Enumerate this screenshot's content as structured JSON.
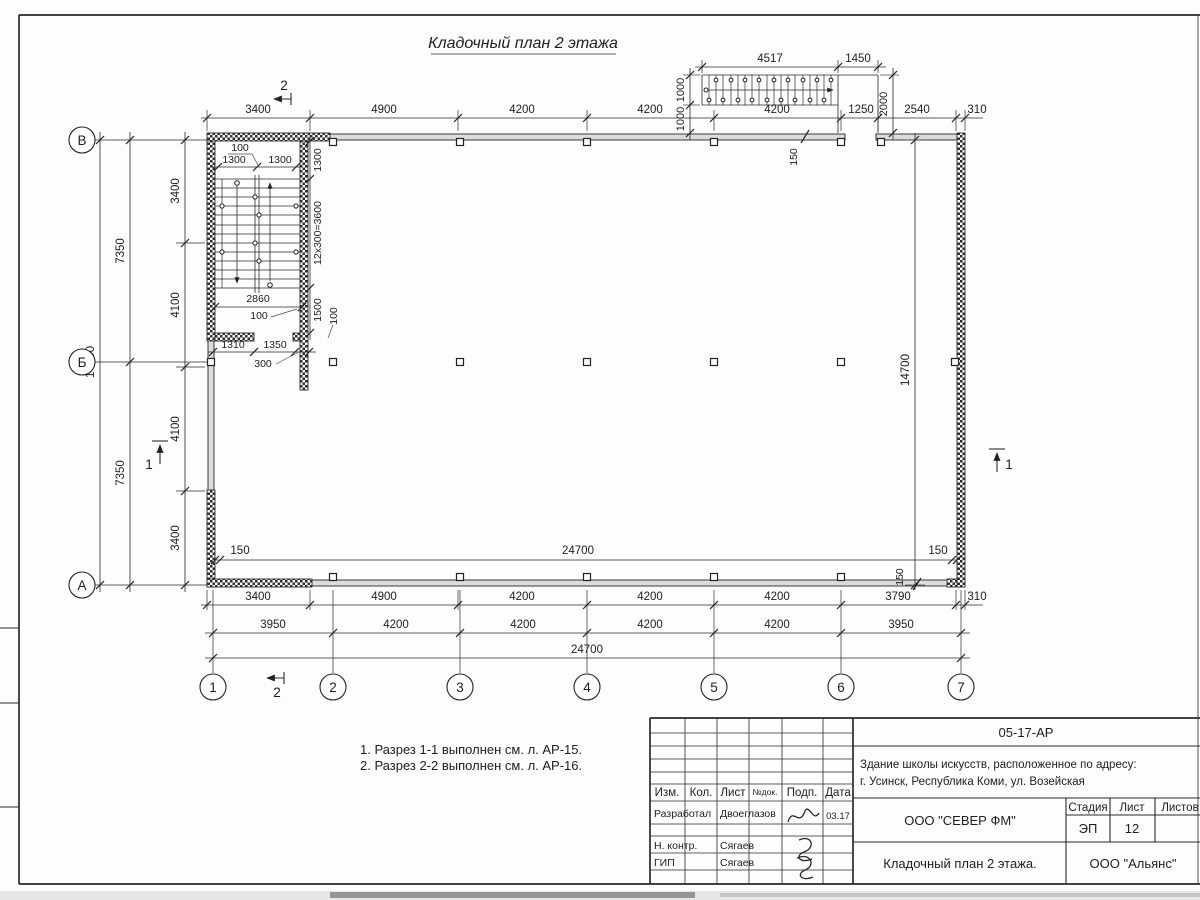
{
  "sheet": {
    "title": "Кладочный план 2 этажа"
  },
  "notes": {
    "line1": "1. Разрез 1-1 выполнен см. л. АР-15.",
    "line2": "2. Разрез 2-2 выполнен см. л. АР-16."
  },
  "axes": {
    "rows": [
      "В",
      "Б",
      "А"
    ],
    "cols": [
      "1",
      "2",
      "3",
      "4",
      "5",
      "6",
      "7"
    ]
  },
  "sections": {
    "s1": "1",
    "s2": "2"
  },
  "dims": {
    "top": [
      "3400",
      "4900",
      "4200",
      "4200",
      "4200",
      "1250",
      "2540",
      "310"
    ],
    "ext_stair": {
      "a": "4517",
      "b": "1450",
      "h": "2000",
      "o1": "1000",
      "o2": "1000",
      "t150": "150"
    },
    "left_total": "14700",
    "left_mid": [
      "7350",
      "7350"
    ],
    "left_inner": [
      "3400",
      "4100",
      "4100",
      "3400"
    ],
    "right_total": "14700",
    "right_150h": "150",
    "right_150v": "150",
    "inner": {
      "l150": "150",
      "total": "24700",
      "r150": "150"
    },
    "b1": [
      "3400",
      "4900",
      "4200",
      "4200",
      "4200",
      "3790",
      "310"
    ],
    "b2": [
      "3950",
      "4200",
      "4200",
      "4200",
      "4200",
      "3950"
    ],
    "b3": "24700",
    "sw": {
      "gap100": "100",
      "fl1": "1300",
      "fl2": "1300",
      "off1300": "1300",
      "steps": "12x300=3600",
      "w2860": "2860",
      "l100": "100",
      "v1500": "1500",
      "v100": "100",
      "d1310": "1310",
      "d1350": "1350",
      "d300": "300"
    }
  },
  "titleblock": {
    "doc_code": "05-17-АР",
    "object_line1": "Здание школы искусств, расположенное по адресу:",
    "object_line2": "г. Усинск, Республика Коми, ул. Возейская",
    "cols": {
      "izm": "Изм.",
      "kol": "Кол.",
      "list": "Лист",
      "ndok": "№док.",
      "podp": "Подп.",
      "data": "Дата"
    },
    "rows": [
      {
        "role": "Разработал",
        "name": "Двоеглазов",
        "date": "03.17"
      },
      {
        "role": "Н. контр.",
        "name": "Сягаев",
        "date": ""
      },
      {
        "role": "ГИП",
        "name": "Сягаев",
        "date": ""
      }
    ],
    "company": "ООО \"СЕВЕР ФМ\"",
    "stage_label": "Стадия",
    "sheet_label": "Лист",
    "sheets_label": "Листов",
    "stage": "ЭП",
    "sheet_no": "12",
    "drawing_title": "Кладочный план 2 этажа.",
    "contractor": "ООО \"Альянс\""
  }
}
